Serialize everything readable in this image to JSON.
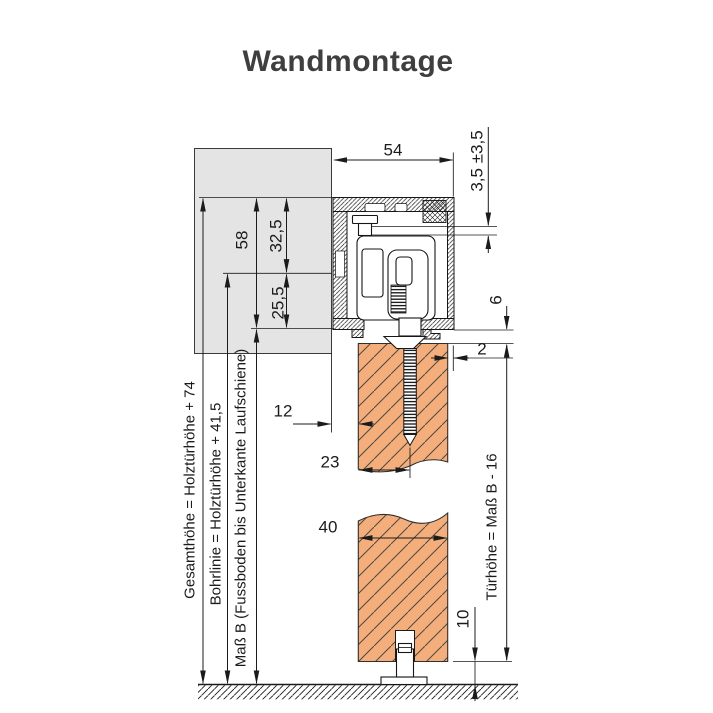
{
  "title": "Wandmontage",
  "drawing": {
    "dims": {
      "track_width": "54",
      "height_adjust": "3,5 ±3,5",
      "track_height": "58",
      "top_to_drill_line": "32,5",
      "drill_to_track_bottom": "25,5",
      "track_to_door_gap": "6",
      "door_track_offset": "2",
      "wall_to_door_gap": "12",
      "edge_to_screw": "23",
      "door_thickness": "40",
      "floor_clearance": "10"
    },
    "labels": {
      "gesamt": "Gesamthöhe = Holztürhöhe + 74",
      "bohrlinie": "Bohrlinie = Holztürhöhe + 41,5",
      "mass_b": "Maß B (Fussboden bis Unterkante Laufschiene)",
      "tuerhoehe": "Türhöhe = Maß B - 16"
    },
    "colors": {
      "door": "#f3ae7b",
      "wall": "#e4e4e4",
      "line": "#1b1b1b",
      "title": "#3f3f3f"
    }
  }
}
